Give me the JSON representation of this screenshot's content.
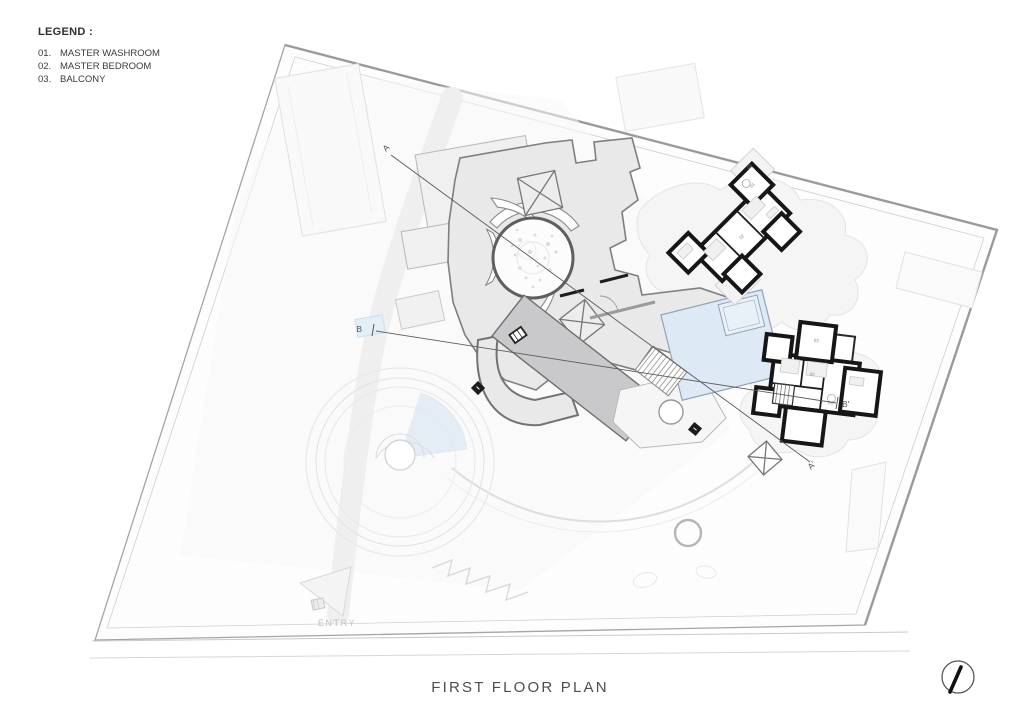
{
  "legend": {
    "title": "LEGEND :",
    "items": [
      {
        "num": "01.",
        "label": "MASTER WASHROOM"
      },
      {
        "num": "02.",
        "label": "MASTER BEDROOM"
      },
      {
        "num": "03.",
        "label": "BALCONY"
      }
    ]
  },
  "plan": {
    "title": "FIRST FLOOR PLAN",
    "entry_label": "ENTRY",
    "section_labels": {
      "a": "A",
      "a_prime": "A'",
      "b": "B",
      "b_prime": "B'"
    },
    "room_numbers": {
      "washroom": "01",
      "bedroom": "02",
      "balcony": "03"
    }
  },
  "icons": {
    "north_arrow": "north-arrow-icon",
    "camera_marker": "camera-marker-icon"
  },
  "colors": {
    "site_outline": "#a0a0a0",
    "inner_wall": "#cfcfcf",
    "building_fill": "#e9e9e9",
    "building_stroke": "#7f7f7f",
    "dark_wing_fill": "#c9c9cb",
    "black_wall": "#161616",
    "pool_blue": "#dde9f4",
    "pool_edge": "#8fa3b8",
    "section_line": "#5a5a5a",
    "muted_text": "#c3c3c3",
    "title_text": "#4d4d4d"
  }
}
